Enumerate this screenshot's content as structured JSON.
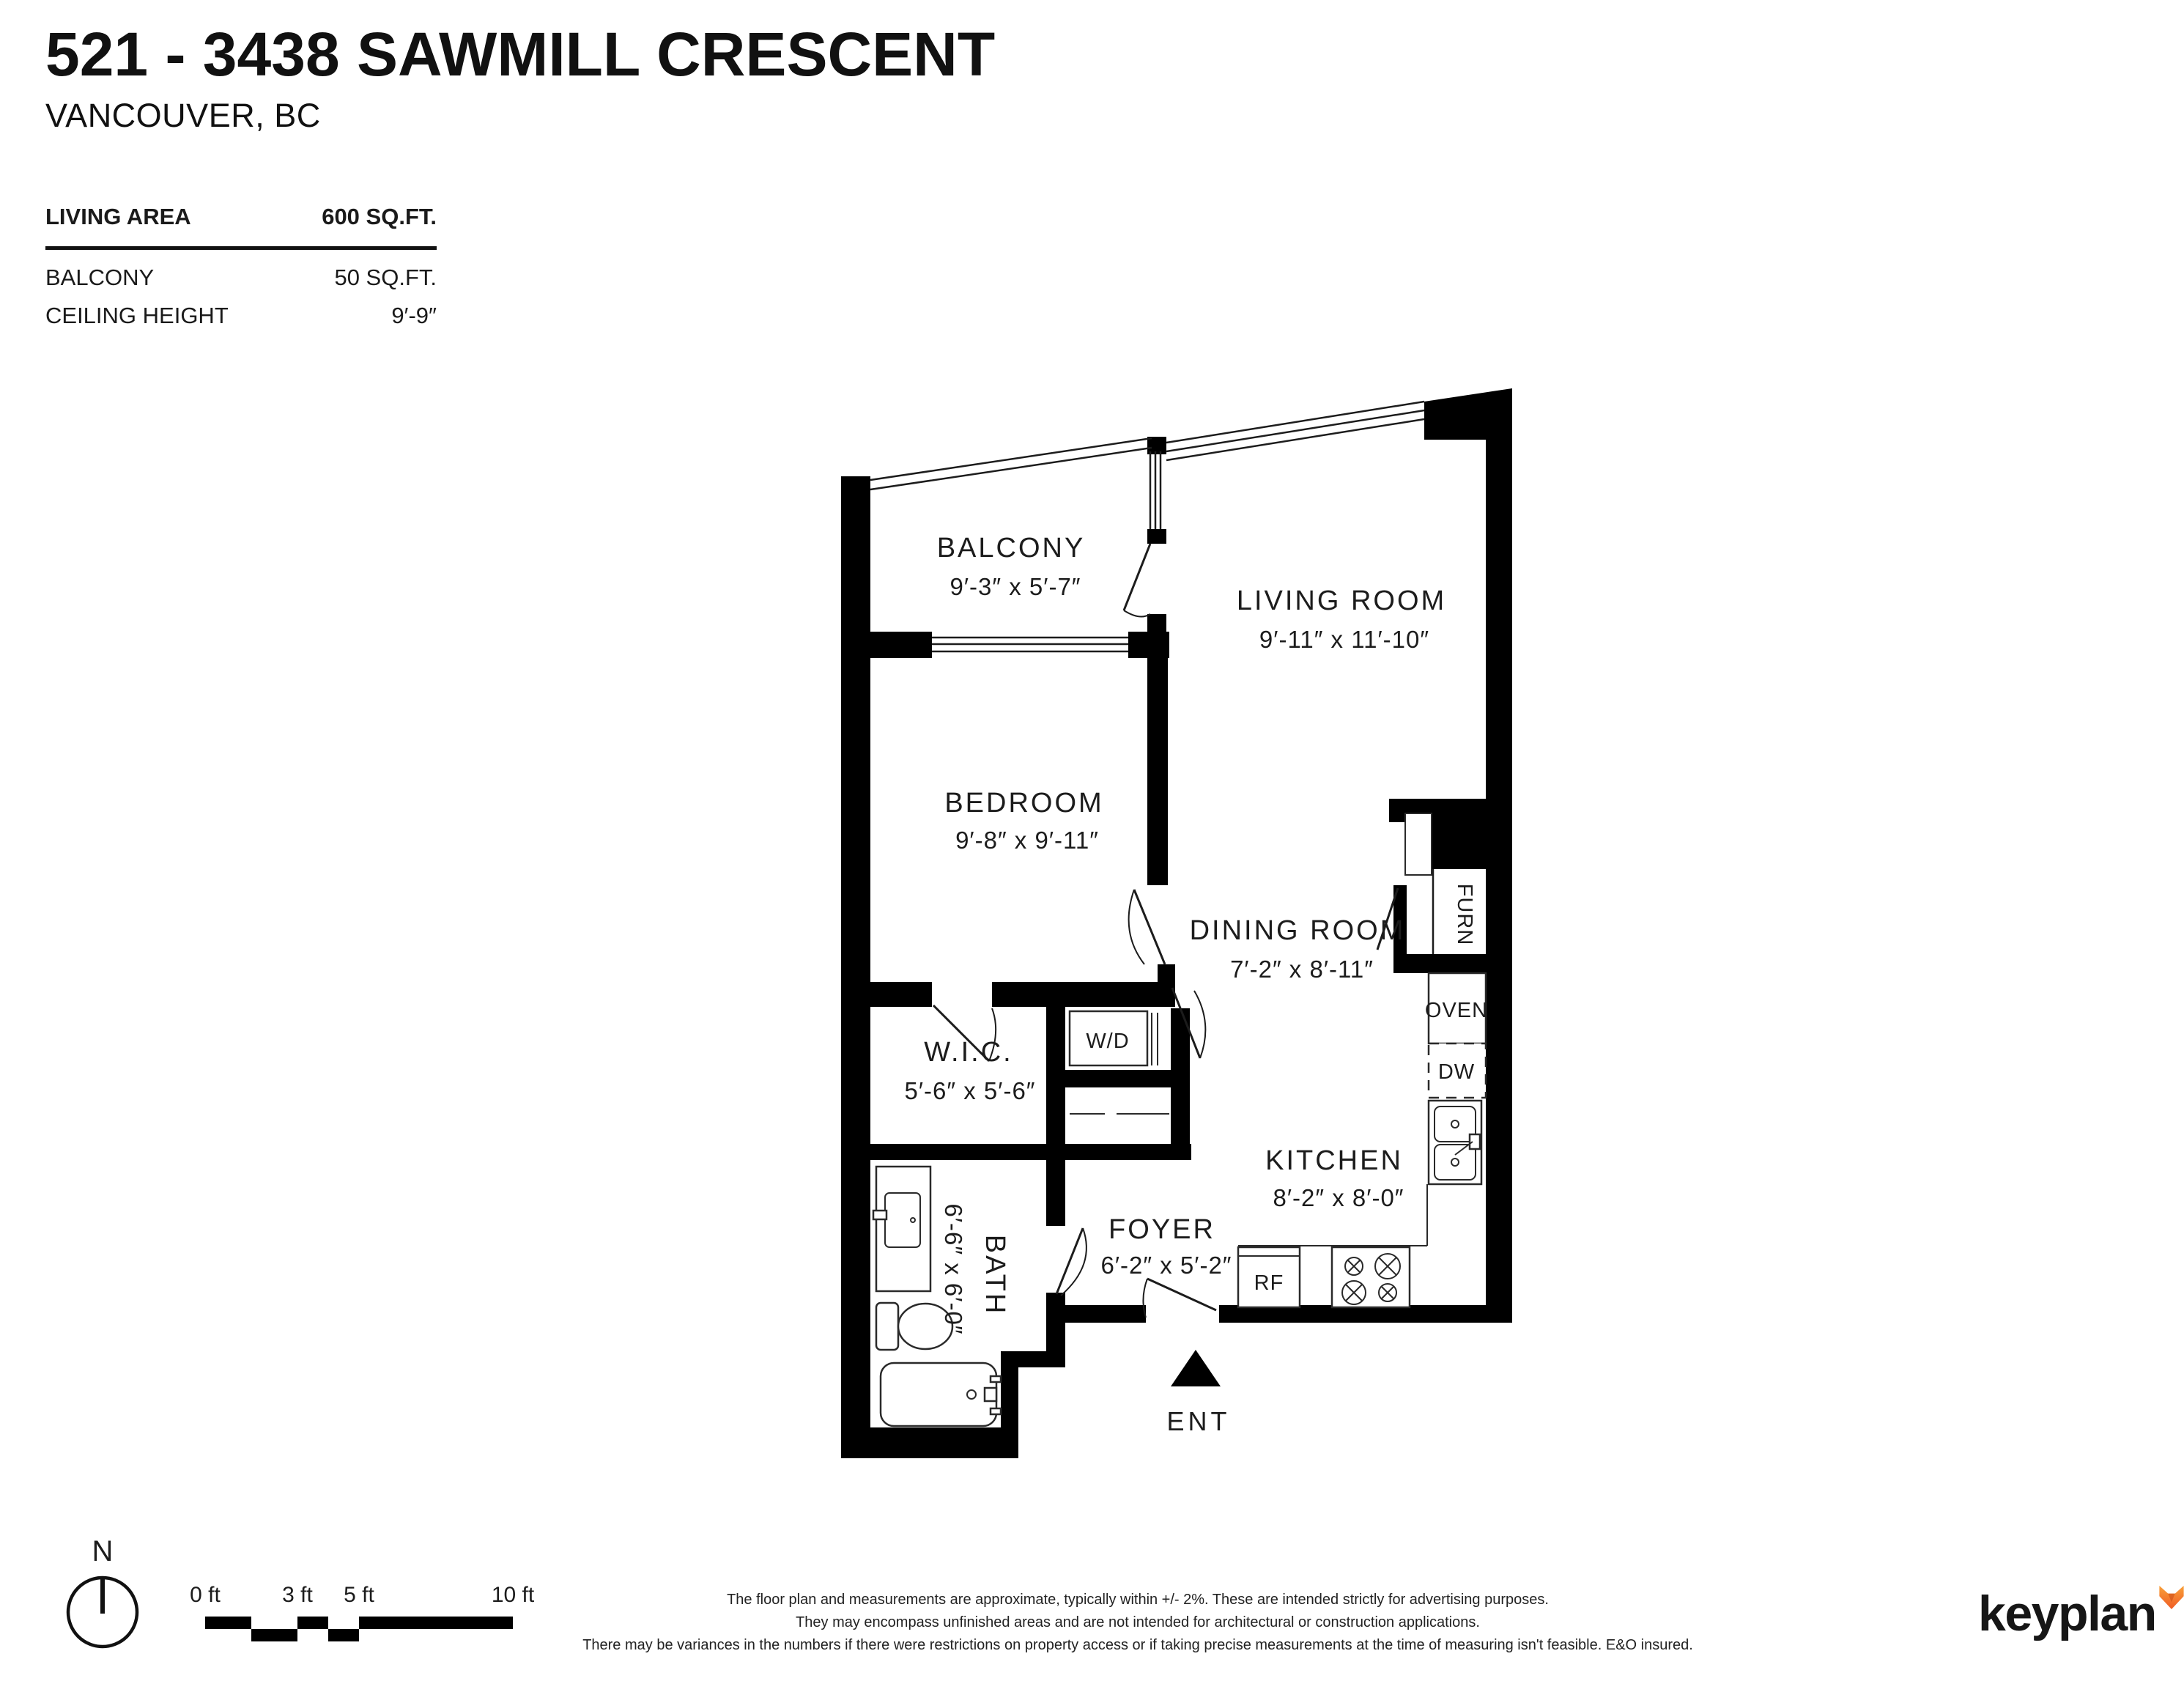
{
  "header": {
    "title": "521 - 3438 SAWMILL CRESCENT",
    "subtitle": "VANCOUVER, BC"
  },
  "stats": {
    "rows": [
      {
        "label": "LIVING AREA",
        "value": "600 SQ.FT."
      },
      {
        "label": "BALCONY",
        "value": "50 SQ.FT."
      },
      {
        "label": "CEILING HEIGHT",
        "value": "9′-9″"
      }
    ]
  },
  "floorplan": {
    "rooms": [
      {
        "name": "BALCONY",
        "dims": "9′-3″  x  5′-7″"
      },
      {
        "name": "LIVING ROOM",
        "dims": "9′-11″  x  11′-10″"
      },
      {
        "name": "BEDROOM",
        "dims": "9′-8″  x  9′-11″"
      },
      {
        "name": "DINING ROOM",
        "dims": "7′-2″ x 8′-11″"
      },
      {
        "name": "W.I.C.",
        "dims": "5′-6″ x 5′-6″"
      },
      {
        "name": "KITCHEN",
        "dims": "8′-2″  x  8′-0″"
      },
      {
        "name": "FOYER",
        "dims": "6′-2″ x 5′-2″"
      },
      {
        "name": "BATH",
        "dims": "6′-6″ x 6′-0″"
      }
    ],
    "fixtures": {
      "washer_dryer": "W/D",
      "furnace": "FURN",
      "oven": "OVEN",
      "dishwasher": "DW",
      "fridge": "RF"
    },
    "entry_label": "ENT"
  },
  "footer": {
    "compass_label": "N",
    "scale_ticks": [
      "0 ft",
      "3 ft",
      "5 ft",
      "10 ft"
    ],
    "disclaimer": [
      "The floor plan and measurements are approximate, typically within +/- 2%. These are intended strictly for advertising purposes.",
      "They may encompass unfinished areas and are not intended for architectural or construction applications.",
      "There may be variances in the numbers if there were restrictions on property access or if taking precise measurements at the time of measuring isn't feasible. E&O insured."
    ],
    "brand": "keyplan",
    "accent_color": "#F58220"
  }
}
